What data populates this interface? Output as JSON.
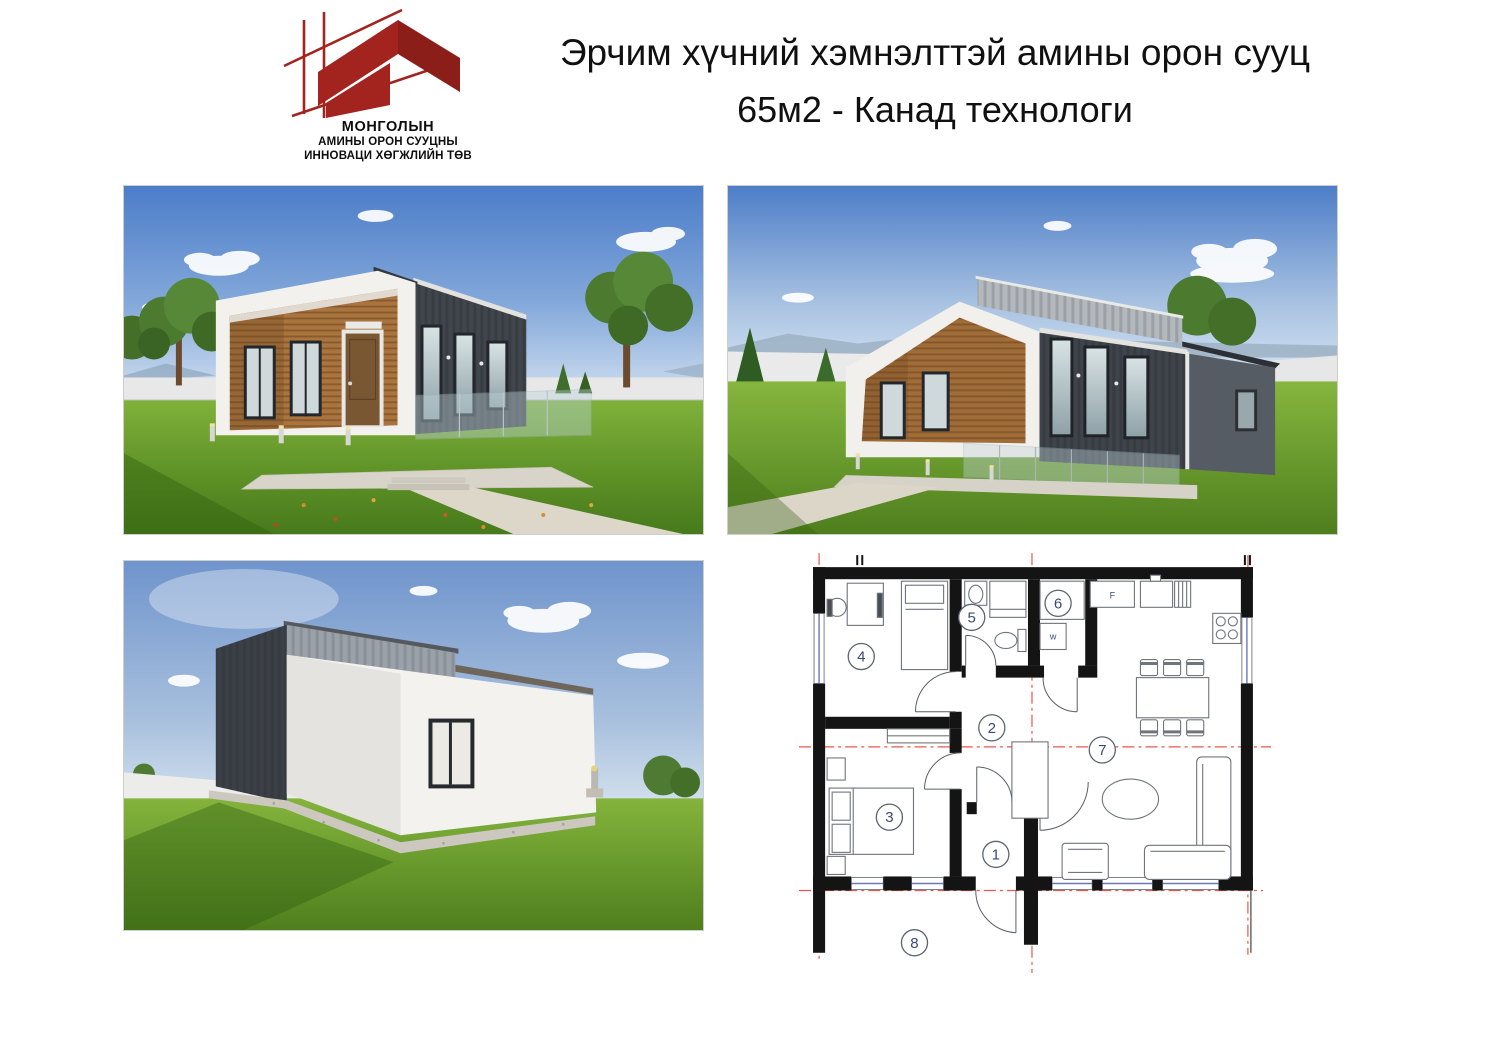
{
  "header": {
    "title_line1": "Эрчим хүчний хэмнэлттэй амины орон сууц",
    "title_line2": "65м2 - Канад технологи"
  },
  "logo": {
    "org_line1": "МОНГОЛЫН",
    "org_line2": "АМИНЫ ОРОН СУУЦНЫ",
    "org_line3": "ИННОВАЦИ ХӨГЖЛИЙН ТӨВ",
    "brand_red": "#a3231e"
  },
  "floor_plan": {
    "wall_color": "#141414",
    "axis_color": "#e8564c",
    "label_color": "#3b4a74",
    "room_labels": [
      "1",
      "2",
      "3",
      "4",
      "5",
      "6",
      "7",
      "8"
    ],
    "fridge_label": "F",
    "washer_label": "w"
  }
}
